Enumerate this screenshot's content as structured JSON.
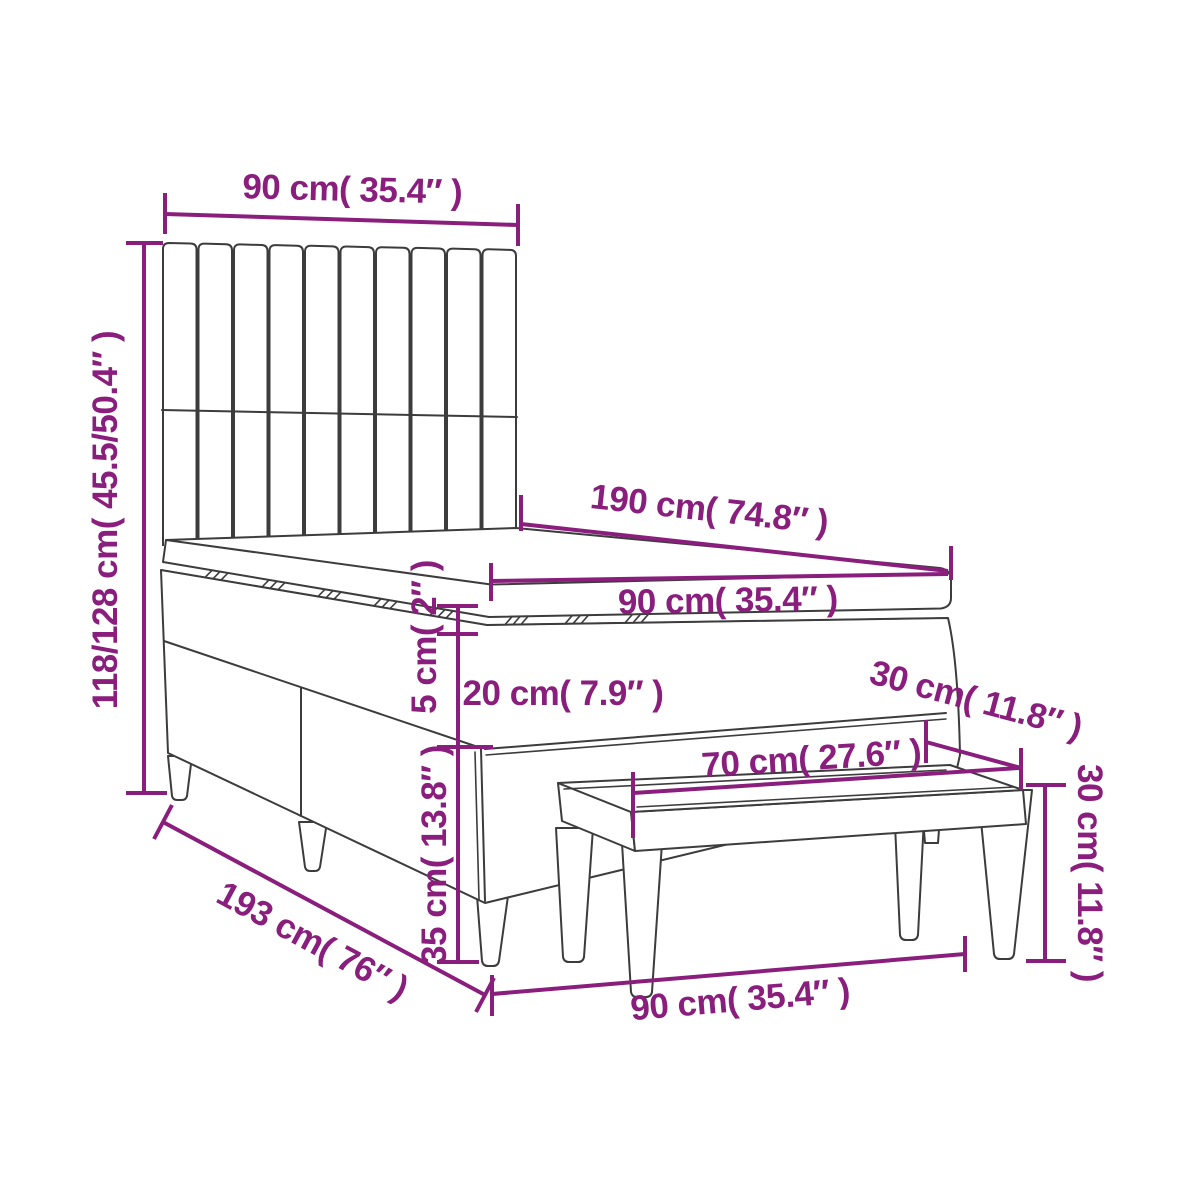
{
  "meta": {
    "type": "furniture-dimension-diagram",
    "subject": "box spring bed with vertical-slat headboard and upholstered bench"
  },
  "colors": {
    "accent": "#8A1E7D",
    "line": "#3c3c3c",
    "background": "#ffffff"
  },
  "labels": {
    "headboard_width": "90 cm( 35.4″ )",
    "bed_height": "118/128 cm( 45.5/50.4″ )",
    "mattress_length": "190 cm( 74.8″ )",
    "mattress_width": "90 cm( 35.4″ )",
    "topper_height": "5 cm( 2″ )",
    "base_height": "20 cm( 7.9″ )",
    "clearance_height": "35 cm( 13.8″ )",
    "bed_length": "193 cm( 76″ )",
    "bench_depth": "30 cm( 11.8″ )",
    "bench_inner_width": "70 cm( 27.6″ )",
    "bench_height": "30 cm( 11.8″ )",
    "bench_width": "90 cm( 35.4″ )"
  },
  "dimensions": [
    {
      "id": "headboard_width",
      "cm": "90",
      "inches": "35.4"
    },
    {
      "id": "bed_height",
      "cm": "118/128",
      "inches": "45.5/50.4"
    },
    {
      "id": "mattress_length",
      "cm": "190",
      "inches": "74.8"
    },
    {
      "id": "mattress_width",
      "cm": "90",
      "inches": "35.4"
    },
    {
      "id": "topper_height",
      "cm": "5",
      "inches": "2"
    },
    {
      "id": "base_height",
      "cm": "20",
      "inches": "7.9"
    },
    {
      "id": "clearance_height",
      "cm": "35",
      "inches": "13.8"
    },
    {
      "id": "bed_length",
      "cm": "193",
      "inches": "76"
    },
    {
      "id": "bench_depth",
      "cm": "30",
      "inches": "11.8"
    },
    {
      "id": "bench_inner_width",
      "cm": "70",
      "inches": "27.6"
    },
    {
      "id": "bench_height",
      "cm": "30",
      "inches": "11.8"
    },
    {
      "id": "bench_width",
      "cm": "90",
      "inches": "35.4"
    }
  ]
}
